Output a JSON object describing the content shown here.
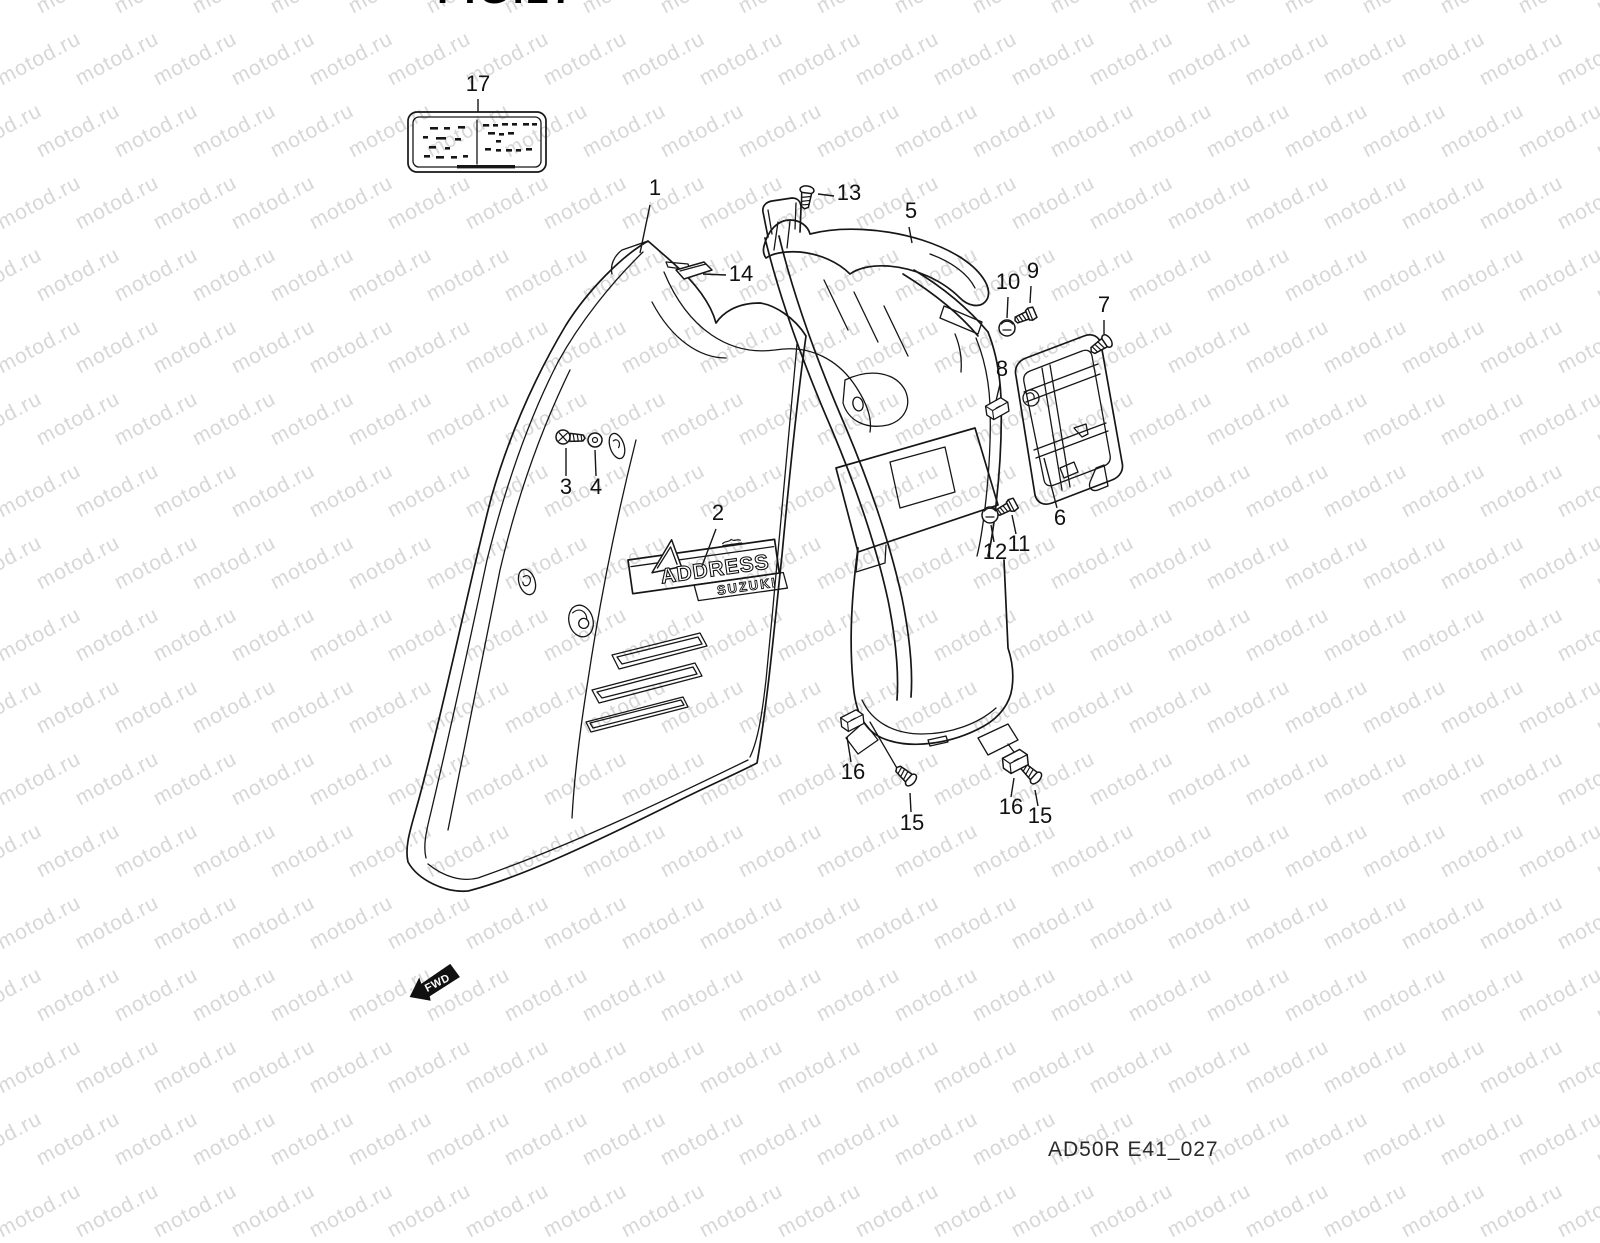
{
  "watermark": {
    "text": "motod.ru",
    "color": "#d7d7d7"
  },
  "header": {
    "figure_label": "FIG.27"
  },
  "footer": {
    "figure_code": "AD50R E41_027"
  },
  "fwd": {
    "label": "FWD"
  },
  "decal": {
    "model": "ADDRESS",
    "brand": "SUZUKI"
  },
  "colors": {
    "line": "#161616",
    "paper": "#ffffff"
  },
  "callouts": [
    {
      "n": "1",
      "x": 655,
      "y": 195,
      "lx1": 650,
      "ly1": 205,
      "lx2": 640,
      "ly2": 253
    },
    {
      "n": "13",
      "x": 849,
      "y": 200,
      "lx1": 834,
      "ly1": 196,
      "lx2": 818,
      "ly2": 194
    },
    {
      "n": "5",
      "x": 911,
      "y": 218,
      "lx1": 909,
      "ly1": 227,
      "lx2": 912,
      "ly2": 243
    },
    {
      "n": "14",
      "x": 741,
      "y": 281,
      "lx1": 726,
      "ly1": 275,
      "lx2": 703,
      "ly2": 274
    },
    {
      "n": "10",
      "x": 1008,
      "y": 289,
      "lx1": 1008,
      "ly1": 297,
      "lx2": 1007,
      "ly2": 318
    },
    {
      "n": "9",
      "x": 1033,
      "y": 278,
      "lx1": 1031,
      "ly1": 286,
      "lx2": 1030,
      "ly2": 303
    },
    {
      "n": "7",
      "x": 1104,
      "y": 312,
      "lx1": 1104,
      "ly1": 320,
      "lx2": 1104,
      "ly2": 334
    },
    {
      "n": "8",
      "x": 1002,
      "y": 376,
      "lx1": 1000,
      "ly1": 384,
      "lx2": 996,
      "ly2": 401
    },
    {
      "n": "3",
      "x": 566,
      "y": 494,
      "lx1": 566,
      "ly1": 476,
      "lx2": 566,
      "ly2": 448
    },
    {
      "n": "4",
      "x": 596,
      "y": 494,
      "lx1": 596,
      "ly1": 476,
      "lx2": 595,
      "ly2": 450
    },
    {
      "n": "2",
      "x": 718,
      "y": 520,
      "lx1": 716,
      "ly1": 529,
      "lx2": 702,
      "ly2": 566
    },
    {
      "n": "6",
      "x": 1060,
      "y": 525,
      "lx1": 1057,
      "ly1": 508,
      "lx2": 1044,
      "ly2": 458
    },
    {
      "n": "12",
      "x": 995,
      "y": 559,
      "lx1": 994,
      "ly1": 542,
      "lx2": 991,
      "ly2": 525
    },
    {
      "n": "11",
      "x": 1019,
      "y": 551,
      "lx1": 1016,
      "ly1": 534,
      "lx2": 1012,
      "ly2": 515
    },
    {
      "n": "16",
      "x": 853,
      "y": 779,
      "lx1": 851,
      "ly1": 762,
      "lx2": 847,
      "ly2": 737
    },
    {
      "n": "15",
      "x": 912,
      "y": 830,
      "lx1": 911,
      "ly1": 812,
      "lx2": 910,
      "ly2": 793
    },
    {
      "n": "16",
      "x": 1011,
      "y": 814,
      "lx1": 1011,
      "ly1": 797,
      "lx2": 1014,
      "ly2": 778
    },
    {
      "n": "15",
      "x": 1040,
      "y": 823,
      "lx1": 1038,
      "ly1": 806,
      "lx2": 1035,
      "ly2": 790
    },
    {
      "n": "17",
      "x": 478,
      "y": 91,
      "lx1": 478,
      "ly1": 99,
      "lx2": 478,
      "ly2": 112
    }
  ]
}
